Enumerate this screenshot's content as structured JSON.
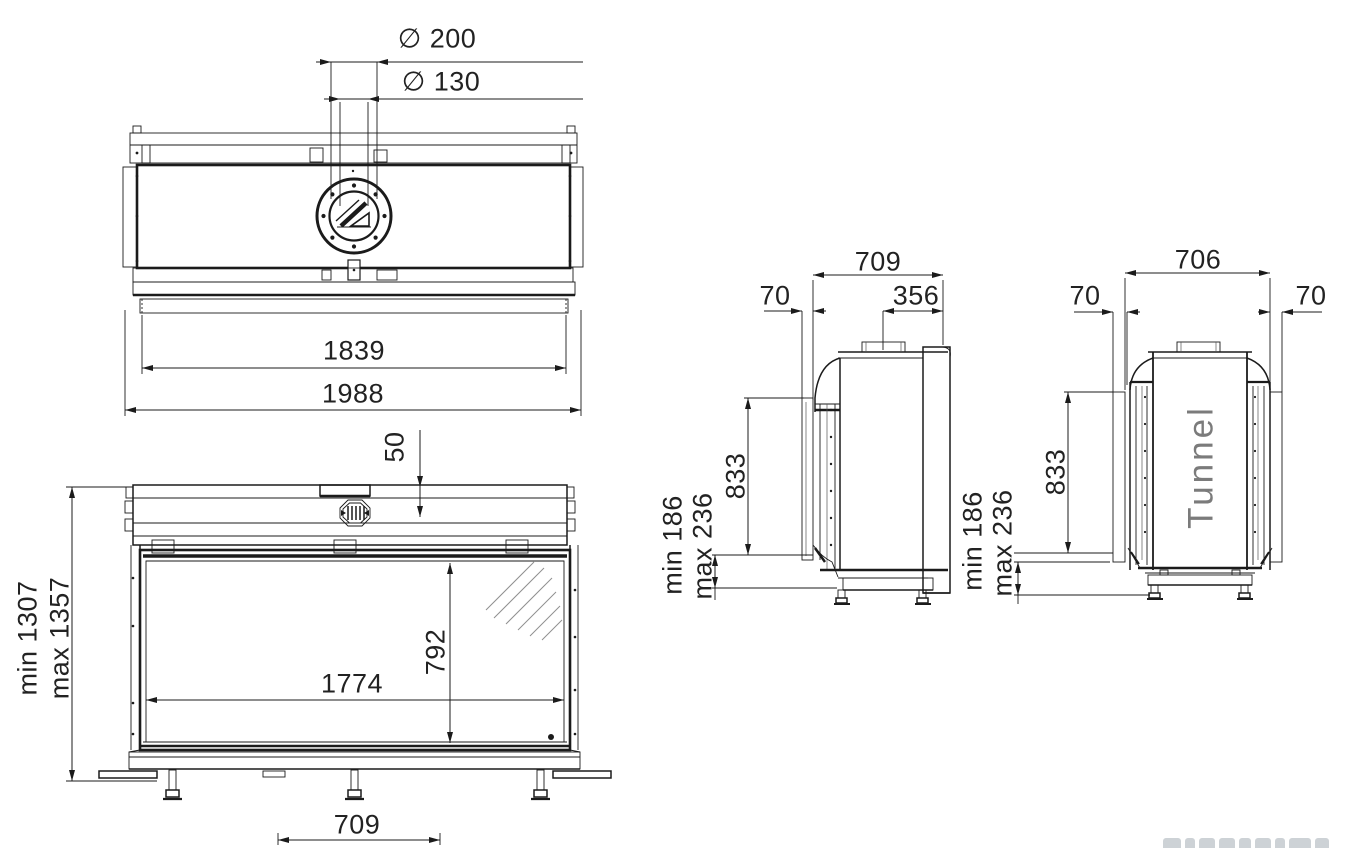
{
  "drawing": {
    "palette": {
      "line": "#1b1b1b",
      "dim_text": "#222222",
      "tunnel_text": "#7b7b7b"
    },
    "top_view": {
      "flue_outer": "∅ 200",
      "flue_inner": "∅ 130",
      "inner_width": "1839",
      "overall_width": "1988"
    },
    "front_view": {
      "top_section": "50",
      "height_min": "min 1307",
      "height_max": "max 1357",
      "glass_width": "1774",
      "glass_height": "792",
      "base_center": "709"
    },
    "side_view": {
      "depth": "709",
      "glass_offset": "70",
      "flue_center_to_back": "356",
      "glass_height": "833",
      "base_min": "min 186",
      "base_max": "max 236"
    },
    "tunnel_view": {
      "model_label": "Tunnel",
      "depth": "706",
      "glass_offset_left": "70",
      "glass_offset_right": "70",
      "glass_height": "833",
      "base_min": "min 186",
      "base_max": "max 236"
    }
  }
}
